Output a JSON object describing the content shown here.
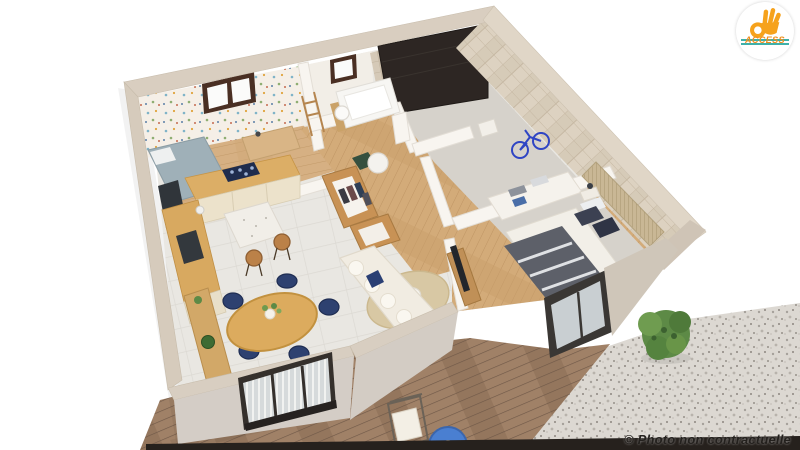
{
  "window": {
    "background": "#ffffff"
  },
  "logo": {
    "text": "ACCESS"
  },
  "watermark": {
    "text": "© Photo non contractuelle"
  },
  "scene": {
    "type": "3d-floorplan-render"
  },
  "palette": {
    "c-orange": "#ef8f1c",
    "c-teal": "#2aa7a0",
    "c-dark": "#24211e",
    "c-wallcap": "#d9cec0",
    "c-stone": "#d2c6b4",
    "c-white-wall": "#f7f4ef",
    "c-tile": "#e9e7e2",
    "c-wood-floor": "#d6b083",
    "c-oak": "#d9a95c",
    "c-cream": "#ece2cb",
    "c-navy": "#2e4170",
    "c-sofa": "#f1ece2",
    "c-rug": "#d8c8a4",
    "c-deck": "#a08167",
    "c-gravel": "#dcd8d2",
    "c-green": "#5d8a46",
    "c-garage-door": "#2d2623",
    "c-bike-blue": "#2f45c4",
    "c-duvet": "#5d6069"
  }
}
